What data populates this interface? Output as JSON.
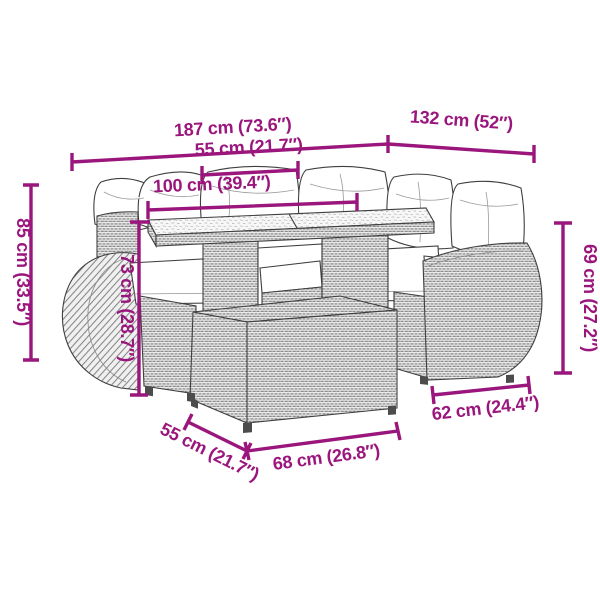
{
  "diagram": {
    "background_color": "#ffffff",
    "accent_color": "#9A167C",
    "line_art_color": "#3f3f3f",
    "dimensions": {
      "total_width": "187 cm (73.6″)",
      "right_section_width": "132 cm (52″)",
      "table_depth": "55 cm (21.7″)",
      "table_width": "100 cm (39.4″)",
      "back_height": "85 cm (33.5″)",
      "table_height": "73 cm (28.7″)",
      "arm_height": "69 cm (27.2″)",
      "arm_section_width": "62 cm (24.4″)",
      "ottoman_depth": "55 cm (21.7″)",
      "ottoman_width": "68 cm (26.8″)"
    }
  }
}
